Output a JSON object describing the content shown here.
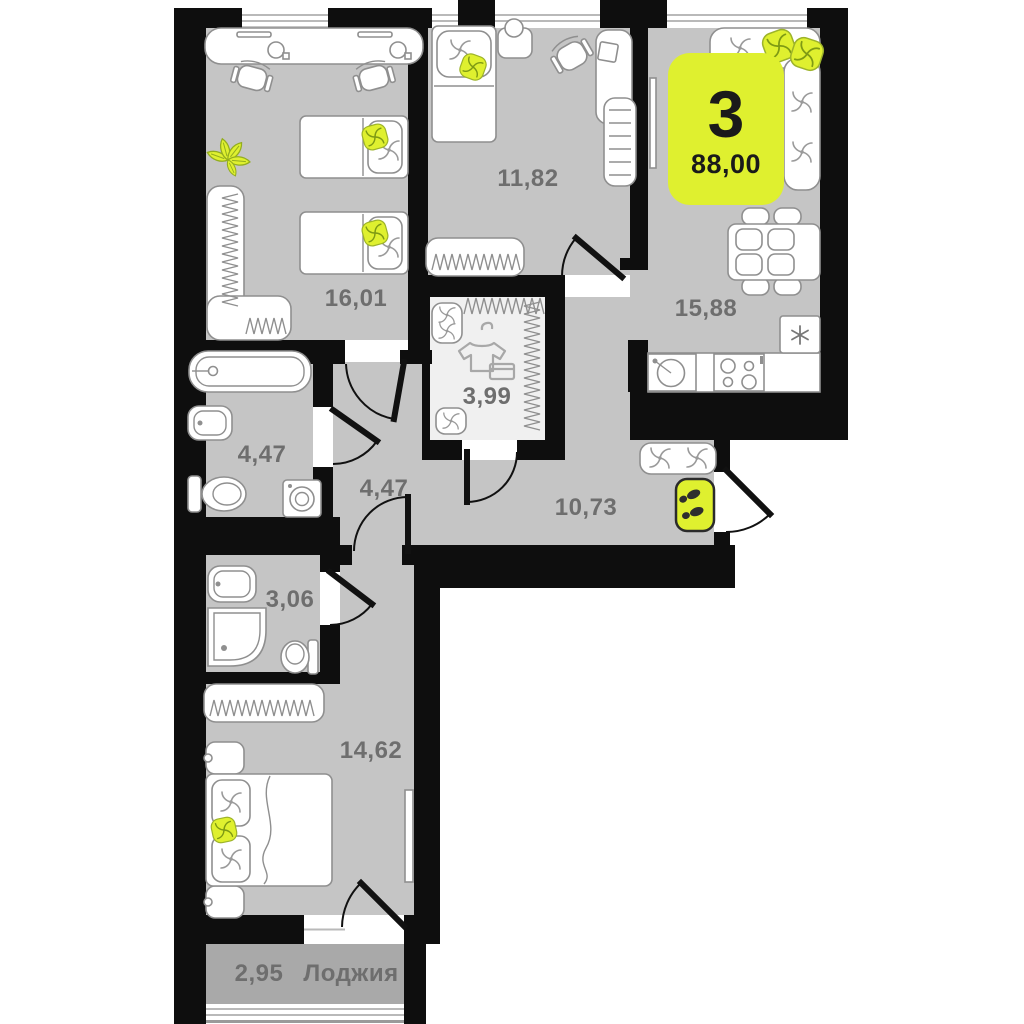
{
  "floor_plan": {
    "badge": {
      "rooms_count": "3",
      "total_area": "88,00"
    },
    "rooms": [
      {
        "name": "bedroom-top-left",
        "area": "16,01"
      },
      {
        "name": "bedroom-top-middle",
        "area": "11,82"
      },
      {
        "name": "kitchen-living-room",
        "area": "15,88"
      },
      {
        "name": "bathroom",
        "area": "4,47"
      },
      {
        "name": "dressing-room",
        "area": "3,99"
      },
      {
        "name": "corridor",
        "area": "4,47"
      },
      {
        "name": "hallway",
        "area": "10,73"
      },
      {
        "name": "shower-wc-room",
        "area": "3,06"
      },
      {
        "name": "bedroom-bottom",
        "area": "14,62"
      },
      {
        "name": "loggia",
        "area": "2,95",
        "label": "Лоджия"
      }
    ],
    "colors": {
      "accent": "#dff02f",
      "wall": "#0e0e0e",
      "floor": "#c5c5c5",
      "loggia_floor": "#a9a9a9",
      "dressing_floor": "#f0f0f0",
      "label_text": "#6e6e6e",
      "badge_text": "#1a1a1a",
      "furniture_outline": "#8f8f8f"
    },
    "icons": {
      "fridge": "snowflake-icon",
      "entrance_mat": "footprints-icon",
      "dressing_room": "tshirt-hanger-icon",
      "plant": "plant-icon",
      "cushions": "swirl-pattern"
    }
  }
}
